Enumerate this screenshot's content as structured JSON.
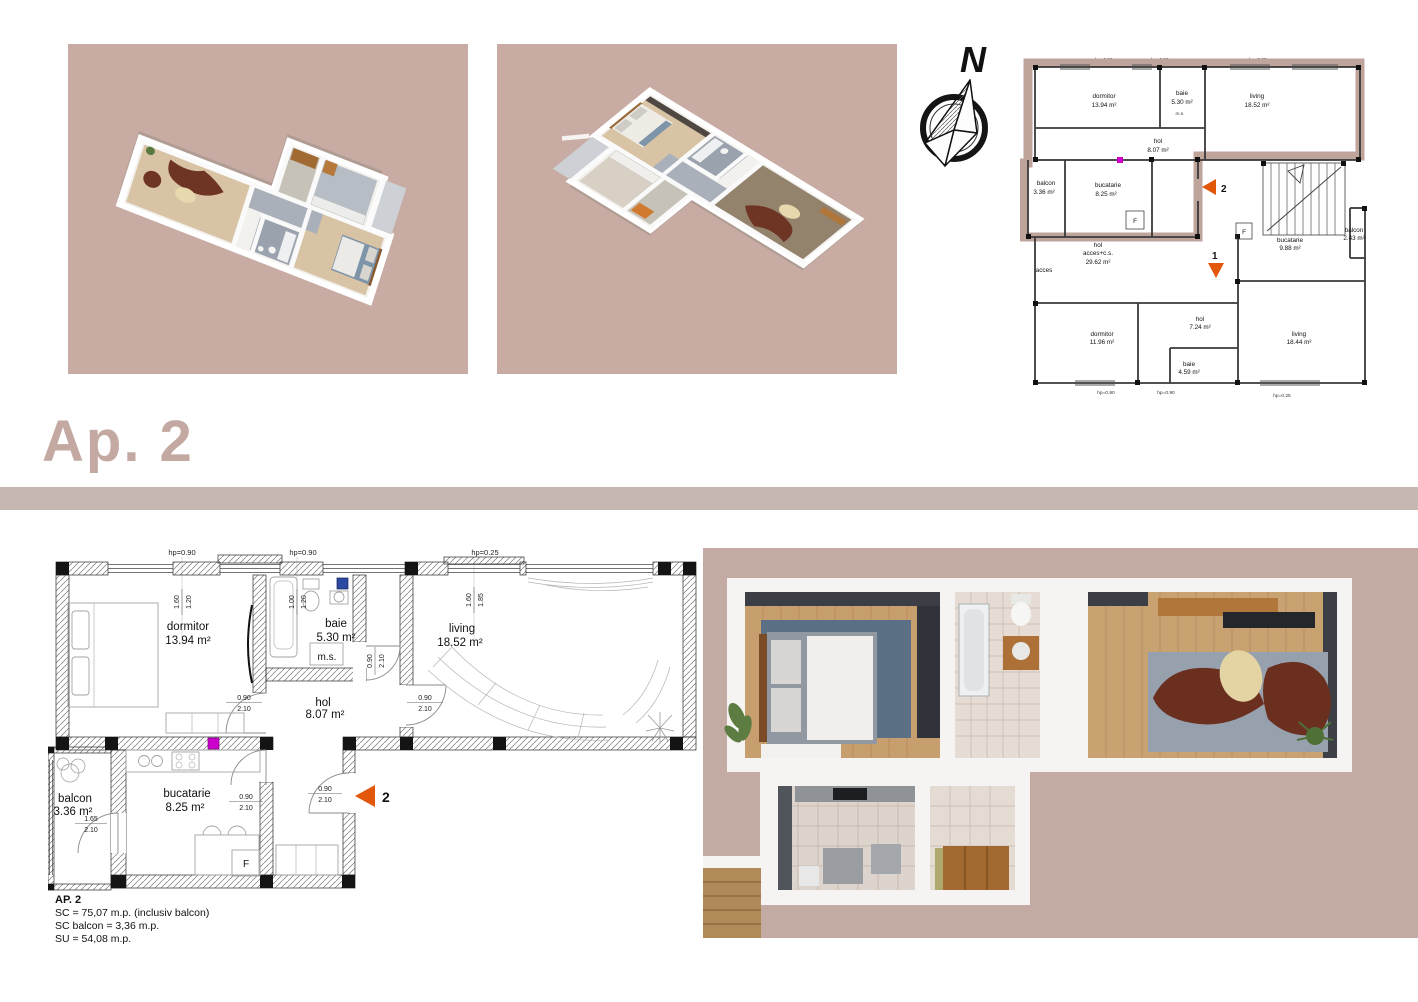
{
  "title": "Ap. 2",
  "compass": {
    "north": "N"
  },
  "colors": {
    "render_bg": "#c8aca4",
    "divider": "#c6b8b0",
    "title": "#c3a9a1",
    "ap2_outline": "#bfa49c",
    "entrance_arrow": "#e3570b",
    "magenta_marker": "#cc00cc",
    "blue_marker": "#2a49a0"
  },
  "siteplan": {
    "hp_top": [
      "hp=0.90",
      "hp=0.90",
      "hp=0.25"
    ],
    "hp_bottom": [
      "hp=0.90",
      "hp=0.90",
      "hp=0.25"
    ],
    "ap2": {
      "dormitor_name": "dormitor",
      "dormitor_area": "13.94 m²",
      "baie_name": "baie",
      "baie_area": "5.30 m²",
      "living_name": "living",
      "living_area": "18.52 m²",
      "hol_name": "hol",
      "hol_area": "8.07 m²",
      "bucatarie_name": "bucatarie",
      "bucatarie_area": "8.25 m²",
      "balcon_name": "balcon",
      "balcon_area": "3.36 m²",
      "ms": "m.s.",
      "fridge": "F",
      "entrance_no": "2"
    },
    "ap1": {
      "hol_acces_line1": "hol",
      "hol_acces_line2": "acces+c.s.",
      "hol_acces_area": "29.62 m²",
      "acces": "acces",
      "dormitor_name": "dormitor",
      "dormitor_area": "11.96 m²",
      "hol_name": "hol",
      "hol_area": "7.24 m²",
      "baie_name": "baie",
      "baie_area": "4.59 m²",
      "living_name": "living",
      "living_area": "18.44 m²",
      "bucatarie_name": "bucatarie",
      "bucatarie_area": "9.88 m²",
      "balcon_name": "balcon",
      "balcon_area": "2.43 m²",
      "fridge": "F",
      "entrance_no": "1"
    }
  },
  "detail": {
    "hp": [
      "hp=0.90",
      "hp=0.90",
      "hp=0.25"
    ],
    "dormitor_name": "dormitor",
    "dormitor_area": "13.94 m²",
    "baie_name": "baie",
    "baie_area": "5.30 m²",
    "living_name": "living",
    "living_area": "18.52 m²",
    "hol_name": "hol",
    "hol_area": "8.07 m²",
    "bucatarie_name": "bucatarie",
    "bucatarie_area": "8.25 m²",
    "balcon_name": "balcon",
    "balcon_area": "3.36 m²",
    "ms": "m.s.",
    "fridge": "F",
    "entrance_no": "2",
    "win_dorm": [
      "1.60",
      "1.20"
    ],
    "win_baie": [
      "1.00",
      "1.20"
    ],
    "win_living": [
      "1.60",
      "1.85"
    ],
    "door": [
      "0.90",
      "2.10"
    ],
    "balcony_door": [
      "1.65",
      "2.10"
    ]
  },
  "annotation": {
    "heading": "AP. 2",
    "line1": "SC =  75,07 m.p. (inclusiv balcon)",
    "line2": "SC balcon = 3,36 m.p.",
    "line3": "SU = 54,08 m.p."
  }
}
